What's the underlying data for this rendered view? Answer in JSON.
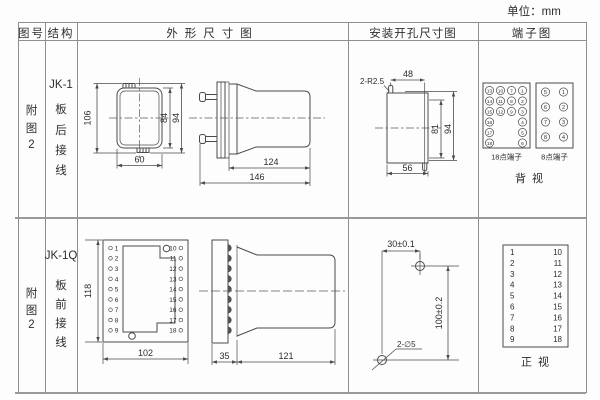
{
  "unit_label": "单位：mm",
  "headers": {
    "fig_no": "图号",
    "structure": "结构",
    "outline": "外形尺寸图",
    "mounting": "安装开孔尺寸图",
    "terminal": "端子图"
  },
  "rows": [
    {
      "fig_chars": [
        "附",
        "图",
        "2"
      ],
      "structure_chars": [
        "JK-1",
        "板",
        "后",
        "接",
        "线"
      ],
      "outline_front": {
        "dim_total_height": "106",
        "dim_inner_height": "84",
        "dim_mid_height": "94",
        "dim_width": "60"
      },
      "outline_side": {
        "dim_body_depth": "124",
        "dim_total_depth": "146"
      },
      "mounting": {
        "slot_label": "2-R2.5",
        "dim_top_width": "48",
        "dim_inner_height": "81",
        "dim_total_height": "94",
        "dim_bottom_width": "56"
      },
      "terminal": {
        "grid18": [
          [
            "13",
            "10",
            "7",
            "1"
          ],
          [
            "14",
            "11",
            "8",
            "2"
          ],
          [
            "15",
            "12",
            "9",
            "3"
          ],
          [
            "16",
            "",
            "",
            "4"
          ],
          [
            "17",
            "",
            "",
            "5"
          ],
          [
            "18",
            "",
            "",
            "6"
          ]
        ],
        "grid8": [
          [
            "5",
            "1"
          ],
          [
            "6",
            "2"
          ],
          [
            "7",
            "3"
          ],
          [
            "8",
            "4"
          ]
        ],
        "label_18": "18点端子",
        "label_8": "8点端子",
        "view_label": "背视"
      }
    },
    {
      "fig_chars": [
        "附",
        "图",
        "2"
      ],
      "structure_chars": [
        "JK-1Q",
        "板",
        "前",
        "接",
        "线"
      ],
      "outline_front": {
        "dim_height": "118",
        "dim_width": "102",
        "left_terminals": [
          "1",
          "2",
          "3",
          "4",
          "5",
          "6",
          "7",
          "8",
          "9"
        ],
        "right_terminals": [
          "10",
          "11",
          "12",
          "13",
          "14",
          "15",
          "16",
          "17",
          "18"
        ]
      },
      "outline_side": {
        "dim_panel_depth": "35",
        "dim_body_depth": "121"
      },
      "mounting": {
        "dim_horizontal": "30±0.1",
        "dim_vertical": "100±0.2",
        "hole_label": "2-∅5"
      },
      "terminal": {
        "left_column": [
          "1",
          "2",
          "3",
          "4",
          "5",
          "6",
          "7",
          "8",
          "9"
        ],
        "right_column": [
          "10",
          "11",
          "12",
          "13",
          "14",
          "15",
          "16",
          "17",
          "18"
        ],
        "view_label": "正视"
      }
    }
  ]
}
